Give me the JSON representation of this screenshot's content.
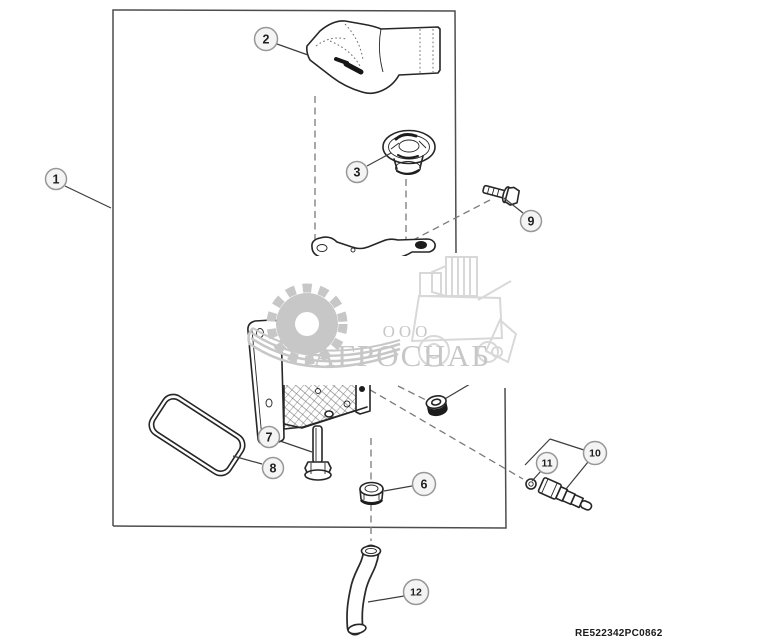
{
  "diagram": {
    "footer_code": "RE522342PC0862",
    "watermark": {
      "org_prefix": "ООО",
      "org_name": "АГРОСНАБ"
    },
    "colors": {
      "line": "#262626",
      "dashed": "#7a7a7a",
      "border": "#4d4d4d",
      "callout_fill": "#f4f4f4",
      "callout_stroke": "#979797",
      "callout_text": "#1f1f1f",
      "leader": "#3d3d3d",
      "wm_gray": "#c7c7c7",
      "wm_light": "#d8d8d8"
    },
    "callouts": [
      {
        "num": "1",
        "cx": 56,
        "cy": 179,
        "r": 10.5,
        "leader": [
          [
            65,
            186
          ],
          [
            111,
            208
          ]
        ]
      },
      {
        "num": "2",
        "cx": 266,
        "cy": 39,
        "r": 11.5,
        "leader": [
          [
            277,
            44
          ],
          [
            308,
            55
          ]
        ]
      },
      {
        "num": "3",
        "cx": 357,
        "cy": 172,
        "r": 10.5,
        "leader": [
          [
            367,
            166
          ],
          [
            391,
            153
          ]
        ]
      },
      {
        "num": "6",
        "cx": 424,
        "cy": 484,
        "r": 11.5,
        "leader": [
          [
            412,
            486
          ],
          [
            384,
            491
          ]
        ]
      },
      {
        "num": "7",
        "cx": 269,
        "cy": 437,
        "r": 10.5,
        "leader": [
          [
            280,
            441
          ],
          [
            312,
            452
          ]
        ]
      },
      {
        "num": "8",
        "cx": 273,
        "cy": 468,
        "r": 10.5,
        "leader": [
          [
            262,
            464
          ],
          [
            233,
            456
          ]
        ]
      },
      {
        "num": "9",
        "cx": 531,
        "cy": 221,
        "r": 10.5,
        "leader": [
          [
            523,
            213
          ],
          [
            504,
            198
          ]
        ]
      },
      {
        "num": "10",
        "cx": 595,
        "cy": 453,
        "r": 11.5,
        "leader": [
          [
            588,
            462
          ],
          [
            566,
            489
          ]
        ],
        "extra_lines": [
          [
            525,
            465,
            550,
            439
          ],
          [
            550,
            439,
            584,
            450
          ]
        ]
      },
      {
        "num": "11",
        "cx": 547,
        "cy": 463,
        "r": 10.5,
        "leader": [
          [
            541,
            471
          ],
          [
            532,
            481
          ]
        ]
      },
      {
        "num": "12",
        "cx": 416,
        "cy": 592,
        "r": 12.5,
        "leader": [
          [
            404,
            596
          ],
          [
            368,
            602
          ]
        ]
      }
    ]
  }
}
